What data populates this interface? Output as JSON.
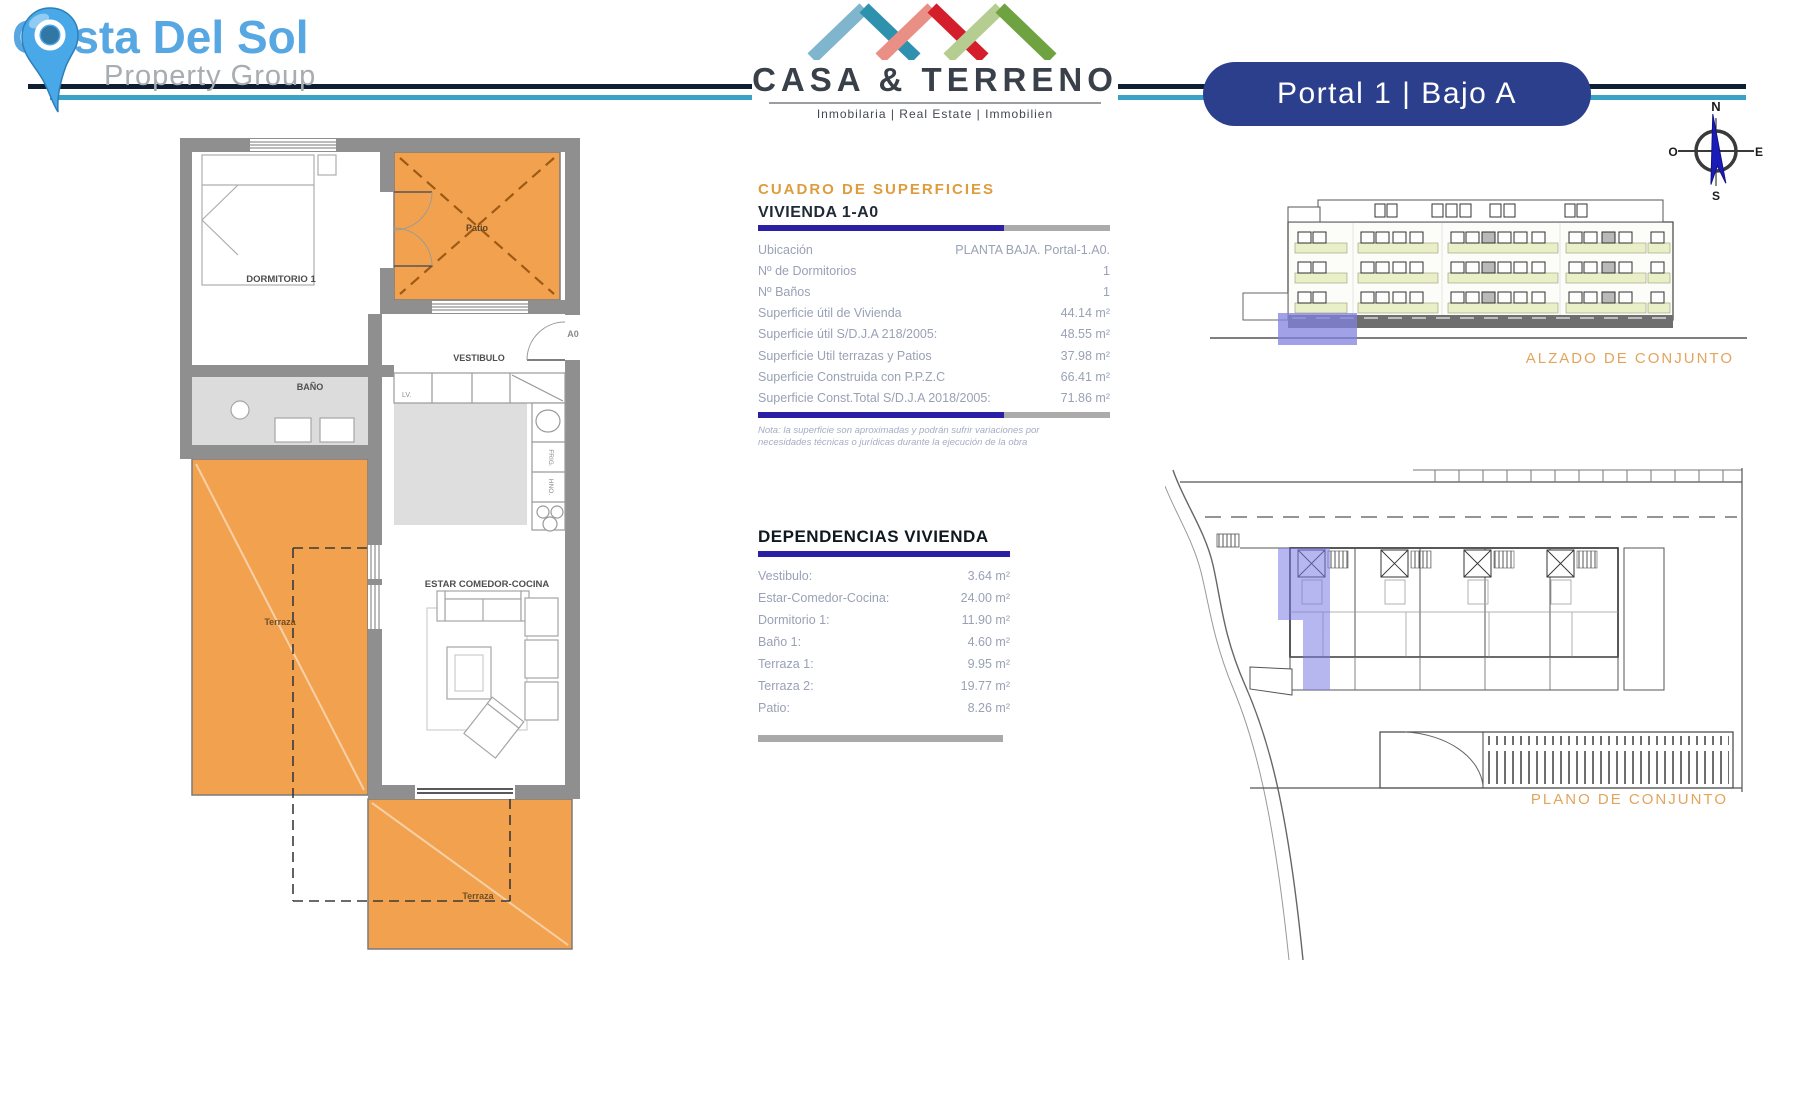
{
  "header": {
    "costa_title": "Costa Del Sol",
    "costa_subtitle": "Property Group",
    "casa_name": "CASA & TERRENO",
    "casa_tagline": "Inmobilaria  |  Real Estate  |  Immobilien",
    "unit_badge": "Portal 1 | Bajo A"
  },
  "compass": {
    "n": "N",
    "e": "E",
    "s": "S",
    "w": "O"
  },
  "surfaces": {
    "title": "CUADRO DE SUPERFICIES",
    "section": "VIVIENDA 1-A0",
    "rows": [
      {
        "label": "Ubicación",
        "value": "PLANTA BAJA. Portal-1.A0."
      },
      {
        "label": "Nº de Dormitorios",
        "value": "1"
      },
      {
        "label": "Nº Baños",
        "value": "1"
      },
      {
        "label": "Superficie útil de Vivienda",
        "value": "44.14 m²"
      },
      {
        "label": "Superficie útil S/D.J.A 218/2005:",
        "value": "48.55 m²"
      },
      {
        "label": "Superficie Util terrazas y Patios",
        "value": "37.98 m²"
      },
      {
        "label": "Superficie Construida con P.P.Z.C",
        "value": "66.41 m²"
      },
      {
        "label": "Superficie Const.Total S/D.J.A 2018/2005:",
        "value": "71.86 m²"
      }
    ],
    "note": "Nota: la superficie son aproximadas y podrán sufrir variaciones por necesidades técnicas o jurídicas durante la ejecución de la obra"
  },
  "dependencies": {
    "title": "DEPENDENCIAS VIVIENDA",
    "rows": [
      {
        "label": "Vestibulo:",
        "value": "3.64 m²"
      },
      {
        "label": "Estar-Comedor-Cocina:",
        "value": "24.00 m²"
      },
      {
        "label": "Dormitorio 1:",
        "value": "11.90 m²"
      },
      {
        "label": "Baño 1:",
        "value": "4.60 m²"
      },
      {
        "label": "Terraza 1:",
        "value": "9.95 m²"
      },
      {
        "label": "Terraza 2:",
        "value": "19.77 m²"
      },
      {
        "label": "Patio:",
        "value": "8.26 m²"
      }
    ]
  },
  "floorplan": {
    "dormitorio": "DORMITORIO 1",
    "bano": "BAÑO",
    "vestibulo": "VESTIBULO",
    "estar": "ESTAR COMEDOR-COCINA",
    "patio": "Patio",
    "terraza_left": "Terraza",
    "terraza_bottom": "Terraza",
    "unit_door": "A0",
    "kitchen_lv": "LV.",
    "kitchen_frig": "FRIG.",
    "kitchen_horno": "HNO."
  },
  "drawings": {
    "alzado_label": "ALZADO DE CONJUNTO",
    "plano_label": "PLANO DE CONJUNTO"
  },
  "colors": {
    "accent_orange": "#E3A45C",
    "terrace_orange": "#F2A24F",
    "bar_navy": "#2B1FA6",
    "bar_gray": "#ABABAB",
    "badge_navy": "#2B3F8D",
    "line_dark": "#0E1E33",
    "line_cyan": "#38A3C6",
    "highlight_lavender": "#7C7CE4"
  }
}
